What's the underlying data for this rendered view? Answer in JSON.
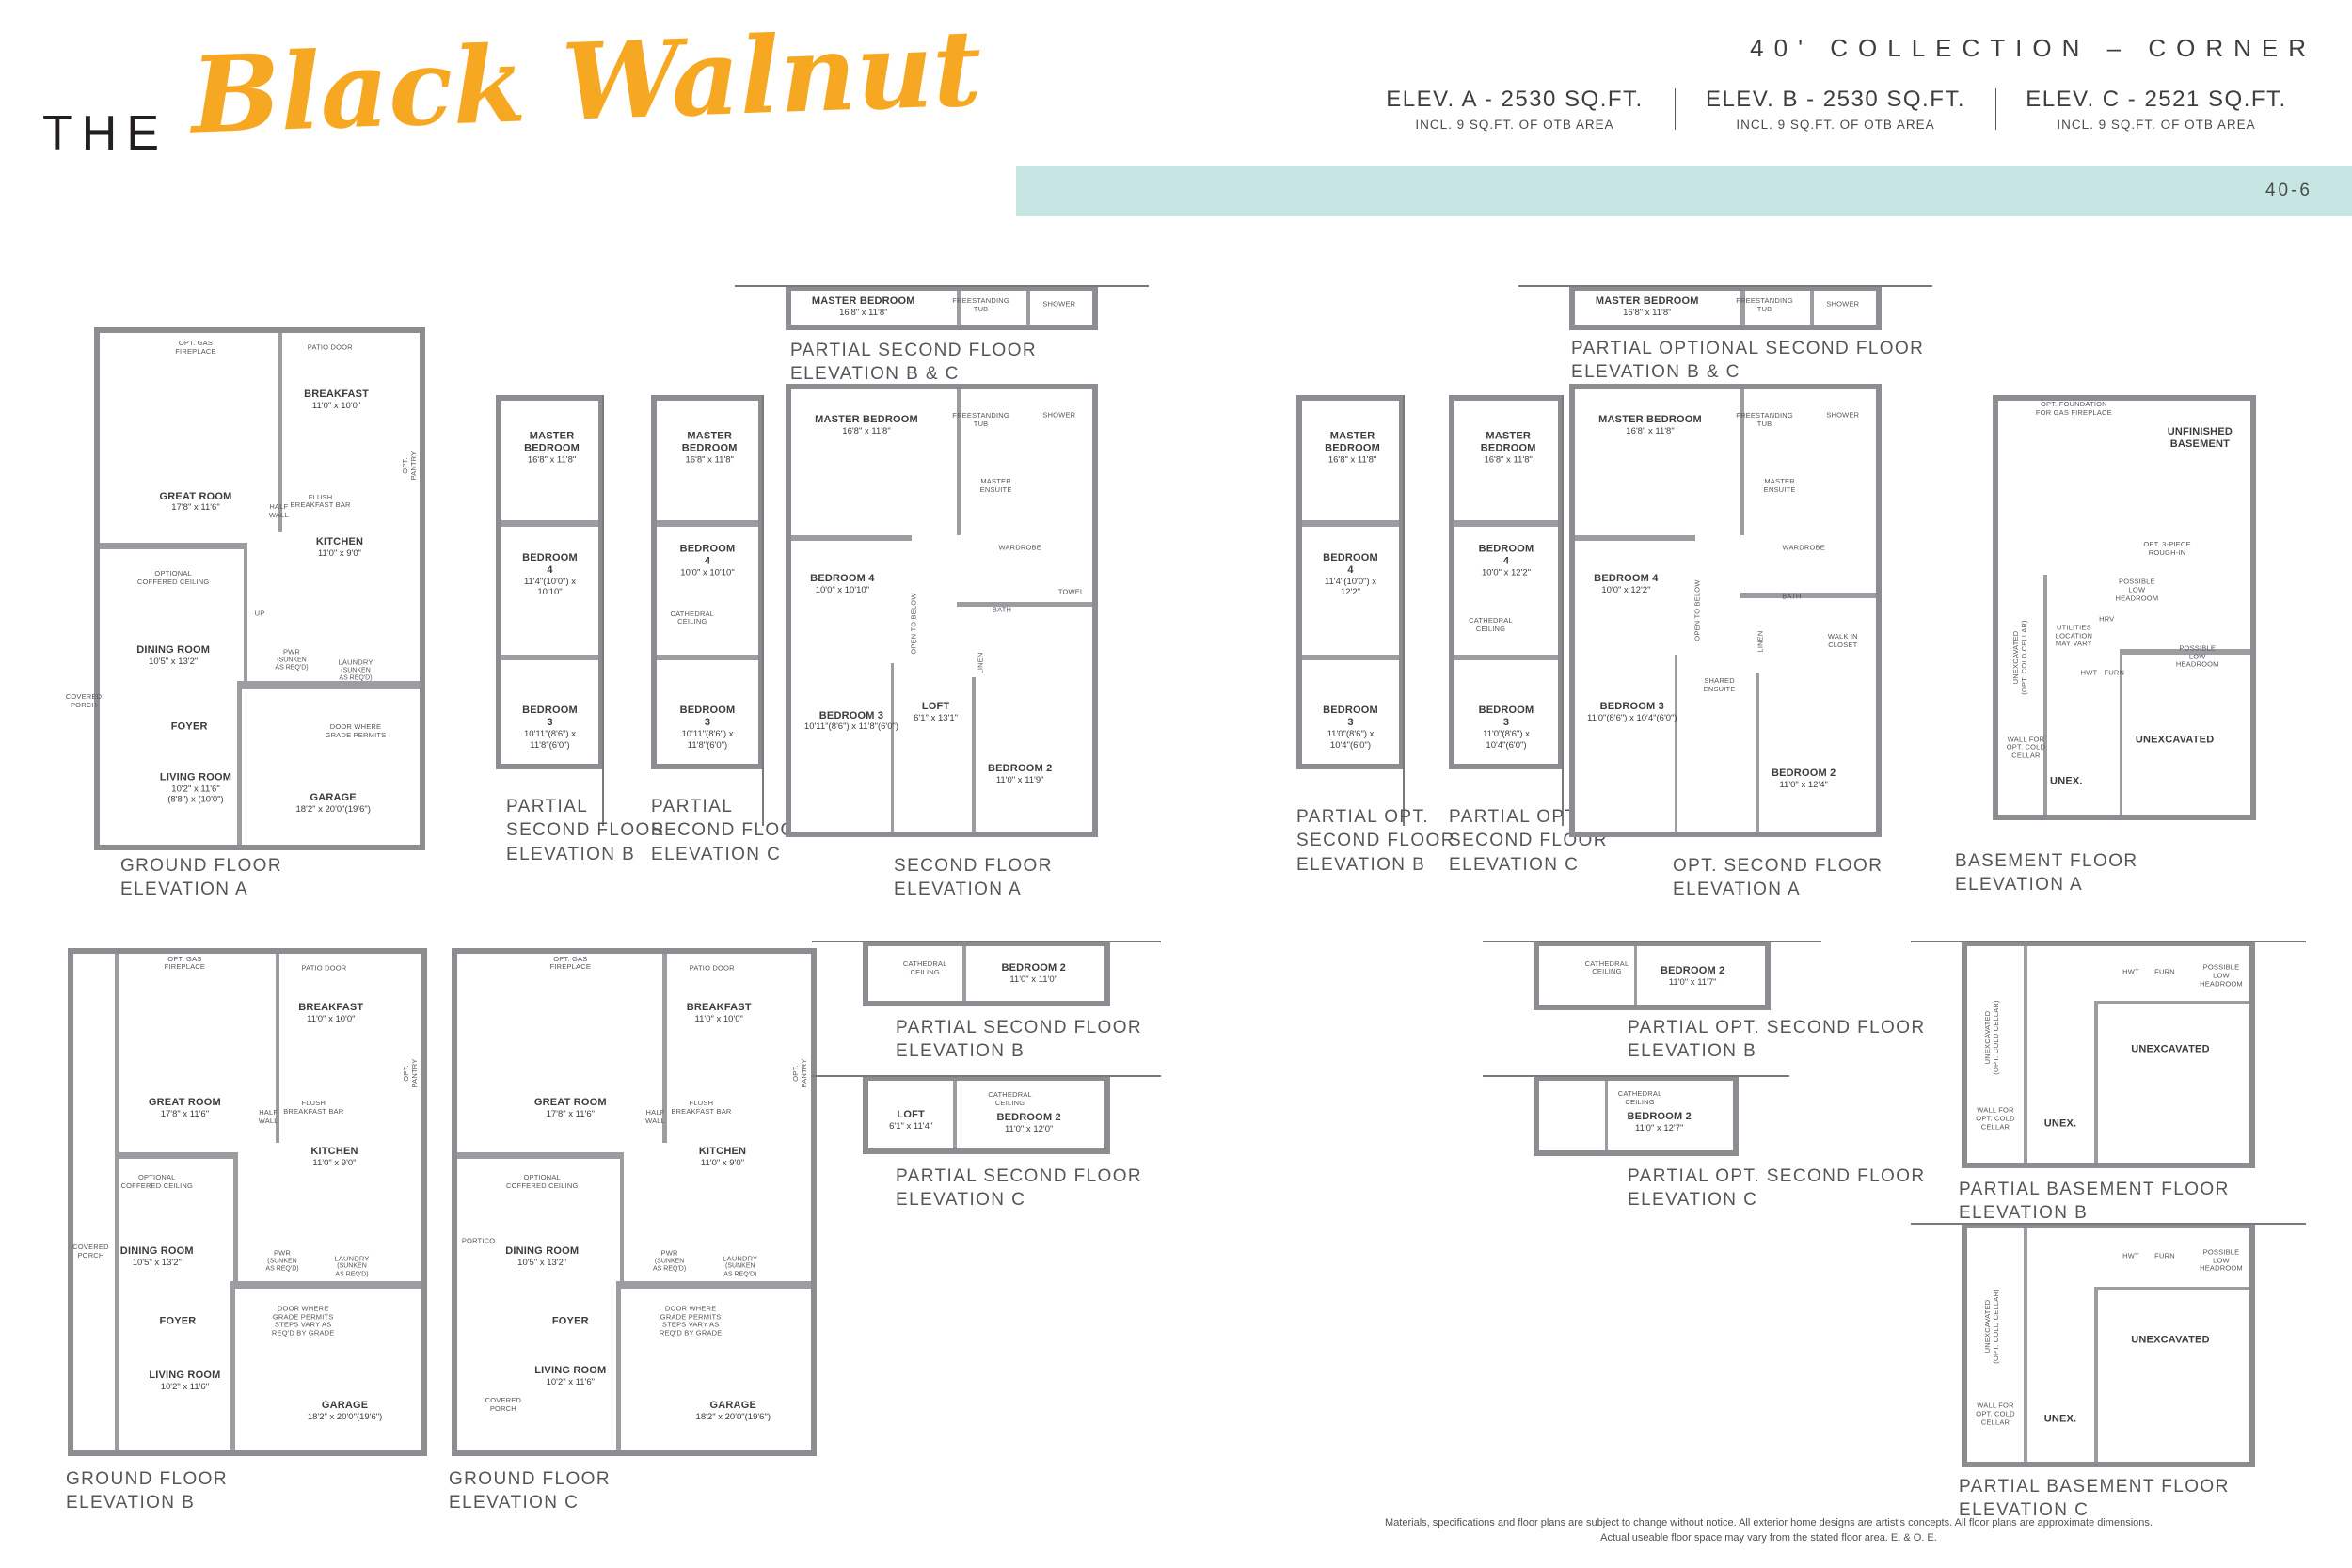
{
  "header": {
    "title_the": "THE",
    "title_name": "Black Walnut",
    "collection": "40' COLLECTION – CORNER",
    "elevations": [
      {
        "label": "ELEV. A - 2530 SQ.FT.",
        "sub": "INCL. 9 SQ.FT. OF OTB AREA"
      },
      {
        "label": "ELEV. B - 2530 SQ.FT.",
        "sub": "INCL. 9 SQ.FT. OF OTB AREA"
      },
      {
        "label": "ELEV. C - 2521 SQ.FT.",
        "sub": "INCL. 9 SQ.FT. OF OTB AREA"
      }
    ],
    "page_code": "40-6",
    "accent_color": "#f7a823",
    "band_color": "#c7e5e2",
    "wall_color": "#8b8d90"
  },
  "plans": [
    {
      "id": "ground-a",
      "caption": [
        "GROUND FLOOR",
        "ELEVATION A"
      ],
      "rooms": [
        {
          "name": "OPT. GAS\nFIREPLACE",
          "minor": true
        },
        {
          "name": "PATIO DOOR",
          "minor": true
        },
        {
          "name": "BREAKFAST",
          "dims": "11'0\" x 10'0\""
        },
        {
          "name": "GREAT ROOM",
          "dims": "17'8\" x 11'6\""
        },
        {
          "name": "HALF\nWALL",
          "minor": true
        },
        {
          "name": "FLUSH\nBREAKFAST BAR",
          "minor": true
        },
        {
          "name": "OPT. PANTRY",
          "minor": true
        },
        {
          "name": "KITCHEN",
          "dims": "11'0\" x 9'0\""
        },
        {
          "name": "OPTIONAL\nCOFFERED CEILING",
          "minor": true
        },
        {
          "name": "DINING ROOM",
          "dims": "10'5\" x 13'2\""
        },
        {
          "name": "PWR",
          "dims": "(SUNKEN\nAS REQ'D)",
          "minor": true
        },
        {
          "name": "LAUNDRY",
          "dims": "(SUNKEN\nAS REQ'D)",
          "minor": true
        },
        {
          "name": "FOYER"
        },
        {
          "name": "DOOR WHERE\nGRADE PERMITS",
          "minor": true
        },
        {
          "name": "COVERED\nPORCH",
          "minor": true
        },
        {
          "name": "LIVING ROOM",
          "dims": "10'2\" x 11'6\"",
          "dims2": "(8'8\") x (10'0\")"
        },
        {
          "name": "GARAGE",
          "dims": "18'2\" x 20'0\"(19'6\")"
        },
        {
          "name": "UP",
          "minor": true
        }
      ]
    },
    {
      "id": "partial-2nd-b-r1",
      "caption": [
        "PARTIAL",
        "SECOND FLOOR",
        "ELEVATION B"
      ],
      "rooms": [
        {
          "name": "MASTER BEDROOM",
          "dims": "16'8\" x 11'8\""
        },
        {
          "name": "BEDROOM 4",
          "dims": "11'4\"(10'0\") x 10'10\""
        },
        {
          "name": "BEDROOM 3",
          "dims": "10'11\"(8'6\") x 11'8\"(6'0\")"
        }
      ]
    },
    {
      "id": "partial-2nd-c-r1",
      "caption": [
        "PARTIAL",
        "SECOND FLOOR",
        "ELEVATION C"
      ],
      "rooms": [
        {
          "name": "MASTER BEDROOM",
          "dims": "16'8\" x 11'8\""
        },
        {
          "name": "BEDROOM 4",
          "dims": "10'0\" x 10'10\""
        },
        {
          "name": "CATHEDRAL\nCEILING",
          "minor": true
        },
        {
          "name": "BEDROOM 3",
          "dims": "10'11\"(8'6\") x 11'8\"(6'0\")"
        }
      ]
    },
    {
      "id": "bc-top-1",
      "caption": [
        "PARTIAL SECOND FLOOR",
        "ELEVATION B & C"
      ],
      "rooms": [
        {
          "name": "MASTER BEDROOM",
          "dims": "16'8\" x 11'8\""
        },
        {
          "name": "FREESTANDING\nTUB",
          "minor": true
        },
        {
          "name": "SHOWER",
          "minor": true
        }
      ]
    },
    {
      "id": "second-a",
      "caption": [
        "SECOND FLOOR",
        "ELEVATION A"
      ],
      "rooms": [
        {
          "name": "MASTER BEDROOM",
          "dims": "16'8\" x 11'8\""
        },
        {
          "name": "FREESTANDING\nTUB",
          "minor": true
        },
        {
          "name": "SHOWER",
          "minor": true
        },
        {
          "name": "MASTER\nENSUITE",
          "minor": true
        },
        {
          "name": "WARDROBE",
          "minor": true
        },
        {
          "name": "BEDROOM 4",
          "dims": "10'0\" x 10'10\""
        },
        {
          "name": "OPEN TO BELOW",
          "minor": true
        },
        {
          "name": "BATH",
          "minor": true
        },
        {
          "name": "TOWEL",
          "minor": true
        },
        {
          "name": "LINEN",
          "minor": true
        },
        {
          "name": "BEDROOM 3",
          "dims": "10'11\"(8'6\") x 11'8\"(6'0\")"
        },
        {
          "name": "LOFT",
          "dims": "6'1\" x 13'1\""
        },
        {
          "name": "BEDROOM 2",
          "dims": "11'0\" x 11'9\""
        }
      ]
    },
    {
      "id": "partial-opt-2nd-b-r1",
      "caption": [
        "PARTIAL OPT.",
        "SECOND FLOOR",
        "ELEVATION B"
      ],
      "rooms": [
        {
          "name": "MASTER BEDROOM",
          "dims": "16'8\" x 11'8\""
        },
        {
          "name": "BEDROOM 4",
          "dims": "11'4\"(10'0\") x 12'2\""
        },
        {
          "name": "BEDROOM 3",
          "dims": "11'0\"(8'6\") x 10'4\"(6'0\")"
        }
      ]
    },
    {
      "id": "partial-opt-2nd-c-r1",
      "caption": [
        "PARTIAL OPT.",
        "SECOND FLOOR",
        "ELEVATION C"
      ],
      "rooms": [
        {
          "name": "MASTER BEDROOM",
          "dims": "16'8\" x 11'8\""
        },
        {
          "name": "BEDROOM 4",
          "dims": "10'0\" x 12'2\""
        },
        {
          "name": "CATHEDRAL\nCEILING",
          "minor": true
        },
        {
          "name": "BEDROOM 3",
          "dims": "11'0\"(8'6\") x 10'4\"(6'0\")"
        }
      ]
    },
    {
      "id": "opt-bc-top",
      "caption": [
        "PARTIAL OPTIONAL SECOND FLOOR",
        "ELEVATION B & C"
      ],
      "rooms": [
        {
          "name": "MASTER BEDROOM",
          "dims": "16'8\" x 11'8\""
        },
        {
          "name": "FREESTANDING\nTUB",
          "minor": true
        },
        {
          "name": "SHOWER",
          "minor": true
        }
      ]
    },
    {
      "id": "opt-second-a",
      "caption": [
        "OPT. SECOND FLOOR",
        "ELEVATION A"
      ],
      "rooms": [
        {
          "name": "MASTER BEDROOM",
          "dims": "16'8\" x 11'8\""
        },
        {
          "name": "FREESTANDING\nTUB",
          "minor": true
        },
        {
          "name": "SHOWER",
          "minor": true
        },
        {
          "name": "MASTER\nENSUITE",
          "minor": true
        },
        {
          "name": "WARDROBE",
          "minor": true
        },
        {
          "name": "BEDROOM 4",
          "dims": "10'0\" x 12'2\""
        },
        {
          "name": "OPEN TO BELOW",
          "minor": true
        },
        {
          "name": "BATH",
          "minor": true
        },
        {
          "name": "WALK IN\nCLOSET",
          "minor": true
        },
        {
          "name": "LINEN",
          "minor": true
        },
        {
          "name": "SHARED\nENSUITE",
          "minor": true
        },
        {
          "name": "BEDROOM 3",
          "dims": "11'0\"(8'6\") x 10'4\"(6'0\")"
        },
        {
          "name": "BEDROOM 2",
          "dims": "11'0\" x 12'4\""
        }
      ]
    },
    {
      "id": "basement-a",
      "caption": [
        "BASEMENT FLOOR",
        "ELEVATION A"
      ],
      "rooms": [
        {
          "name": "OPT. FOUNDATION\nFOR GAS FIREPLACE",
          "minor": true
        },
        {
          "name": "UNFINISHED\nBASEMENT"
        },
        {
          "name": "OPT. 3-PIECE\nROUGH-IN",
          "minor": true
        },
        {
          "name": "POSSIBLE\nLOW\nHEADROOM",
          "minor": true
        },
        {
          "name": "HRV",
          "minor": true
        },
        {
          "name": "UTILITIES\nLOCATION\nMAY VARY",
          "minor": true
        },
        {
          "name": "HWT",
          "minor": true
        },
        {
          "name": "FURN",
          "minor": true
        },
        {
          "name": "POSSIBLE\nLOW\nHEADROOM",
          "minor": true
        },
        {
          "name": "UNEXCAVATED\n(OPT. COLD CELLAR)",
          "minor": true
        },
        {
          "name": "WALL FOR\nOPT. COLD\nCELLAR",
          "minor": true
        },
        {
          "name": "UNEX."
        },
        {
          "name": "UNEXCAVATED"
        }
      ]
    },
    {
      "id": "ground-b",
      "caption": [
        "GROUND FLOOR",
        "ELEVATION B"
      ],
      "rooms": [
        {
          "name": "OPT. GAS\nFIREPLACE",
          "minor": true
        },
        {
          "name": "PATIO DOOR",
          "minor": true
        },
        {
          "name": "BREAKFAST",
          "dims": "11'0\" x 10'0\""
        },
        {
          "name": "GREAT ROOM",
          "dims": "17'8\" x 11'6\""
        },
        {
          "name": "HALF\nWALL",
          "minor": true
        },
        {
          "name": "FLUSH\nBREAKFAST BAR",
          "minor": true
        },
        {
          "name": "OPT. PANTRY",
          "minor": true
        },
        {
          "name": "KITCHEN",
          "dims": "11'0\" x 9'0\""
        },
        {
          "name": "OPTIONAL\nCOFFERED CEILING",
          "minor": true
        },
        {
          "name": "DINING ROOM",
          "dims": "10'5\" x 13'2\""
        },
        {
          "name": "PWR",
          "dims": "(SUNKEN\nAS REQ'D)",
          "minor": true
        },
        {
          "name": "LAUNDRY",
          "dims": "(SUNKEN\nAS REQ'D)",
          "minor": true
        },
        {
          "name": "FOYER"
        },
        {
          "name": "DOOR WHERE\nGRADE PERMITS\nSTEPS VARY AS\nREQ'D BY GRADE",
          "minor": true
        },
        {
          "name": "COVERED\nPORCH",
          "minor": true
        },
        {
          "name": "LIVING ROOM",
          "dims": "10'2\" x 11'6\""
        },
        {
          "name": "GARAGE",
          "dims": "18'2\" x 20'0\"(19'6\")"
        }
      ]
    },
    {
      "id": "ground-c",
      "caption": [
        "GROUND FLOOR",
        "ELEVATION C"
      ],
      "rooms": [
        {
          "name": "OPT. GAS\nFIREPLACE",
          "minor": true
        },
        {
          "name": "PATIO DOOR",
          "minor": true
        },
        {
          "name": "BREAKFAST",
          "dims": "11'0\" x 10'0\""
        },
        {
          "name": "GREAT ROOM",
          "dims": "17'8\" x 11'6\""
        },
        {
          "name": "HALF\nWALL",
          "minor": true
        },
        {
          "name": "FLUSH\nBREAKFAST BAR",
          "minor": true
        },
        {
          "name": "OPT. PANTRY",
          "minor": true
        },
        {
          "name": "KITCHEN",
          "dims": "11'0\" x 9'0\""
        },
        {
          "name": "OPTIONAL\nCOFFERED CEILING",
          "minor": true
        },
        {
          "name": "DINING ROOM",
          "dims": "10'5\" x 13'2\""
        },
        {
          "name": "PWR",
          "dims": "(SUNKEN\nAS REQ'D)",
          "minor": true
        },
        {
          "name": "LAUNDRY",
          "dims": "(SUNKEN\nAS REQ'D)",
          "minor": true
        },
        {
          "name": "FOYER"
        },
        {
          "name": "DOOR WHERE\nGRADE PERMITS\nSTEPS VARY AS\nREQ'D BY GRADE",
          "minor": true
        },
        {
          "name": "PORTICO",
          "minor": true
        },
        {
          "name": "COVERED\nPORCH",
          "minor": true
        },
        {
          "name": "LIVING ROOM",
          "dims": "10'2\" x 11'6\""
        },
        {
          "name": "GARAGE",
          "dims": "18'2\" x 20'0\"(19'6\")"
        }
      ]
    },
    {
      "id": "partial-2nd-b-r2",
      "caption": [
        "PARTIAL SECOND FLOOR",
        "ELEVATION B"
      ],
      "rooms": [
        {
          "name": "CATHEDRAL\nCEILING",
          "minor": true
        },
        {
          "name": "BEDROOM 2",
          "dims": "11'0\" x 11'0\""
        }
      ]
    },
    {
      "id": "partial-2nd-c-r2",
      "caption": [
        "PARTIAL SECOND FLOOR",
        "ELEVATION C"
      ],
      "rooms": [
        {
          "name": "LOFT",
          "dims": "6'1\" x 11'4\""
        },
        {
          "name": "CATHEDRAL\nCEILING",
          "minor": true
        },
        {
          "name": "BEDROOM 2",
          "dims": "11'0\" x 12'0\""
        }
      ]
    },
    {
      "id": "partial-opt-2nd-b-r2",
      "caption": [
        "PARTIAL OPT. SECOND FLOOR",
        "ELEVATION B"
      ],
      "rooms": [
        {
          "name": "CATHEDRAL\nCEILING",
          "minor": true
        },
        {
          "name": "BEDROOM 2",
          "dims": "11'0\" x 11'7\""
        }
      ]
    },
    {
      "id": "partial-opt-2nd-c-r2",
      "caption": [
        "PARTIAL OPT. SECOND FLOOR",
        "ELEVATION C"
      ],
      "rooms": [
        {
          "name": "CATHEDRAL\nCEILING",
          "minor": true
        },
        {
          "name": "BEDROOM 2",
          "dims": "11'0\" x 12'7\""
        }
      ]
    },
    {
      "id": "partial-basement-b",
      "caption": [
        "PARTIAL BASEMENT FLOOR",
        "ELEVATION B"
      ],
      "rooms": [
        {
          "name": "HWT",
          "minor": true
        },
        {
          "name": "FURN",
          "minor": true
        },
        {
          "name": "POSSIBLE\nLOW\nHEADROOM",
          "minor": true
        },
        {
          "name": "UNEXCAVATED\n(OPT. COLD CELLAR)",
          "minor": true
        },
        {
          "name": "UNEXCAVATED"
        },
        {
          "name": "WALL FOR\nOPT. COLD\nCELLAR",
          "minor": true
        },
        {
          "name": "UNEX."
        }
      ]
    },
    {
      "id": "partial-basement-c",
      "caption": [
        "PARTIAL BASEMENT FLOOR",
        "ELEVATION C"
      ],
      "rooms": [
        {
          "name": "HWT",
          "minor": true
        },
        {
          "name": "FURN",
          "minor": true
        },
        {
          "name": "POSSIBLE\nLOW\nHEADROOM",
          "minor": true
        },
        {
          "name": "UNEXCAVATED\n(OPT. COLD CELLAR)",
          "minor": true
        },
        {
          "name": "UNEXCAVATED"
        },
        {
          "name": "WALL FOR\nOPT. COLD\nCELLAR",
          "minor": true
        },
        {
          "name": "UNEX."
        }
      ]
    }
  ],
  "footer": {
    "line1": "Materials, specifications and floor plans are subject to change without notice. All exterior home designs are artist's concepts. All floor plans are approximate dimensions.",
    "line2": "Actual useable floor space may vary from the stated floor area. E. & O. E."
  }
}
